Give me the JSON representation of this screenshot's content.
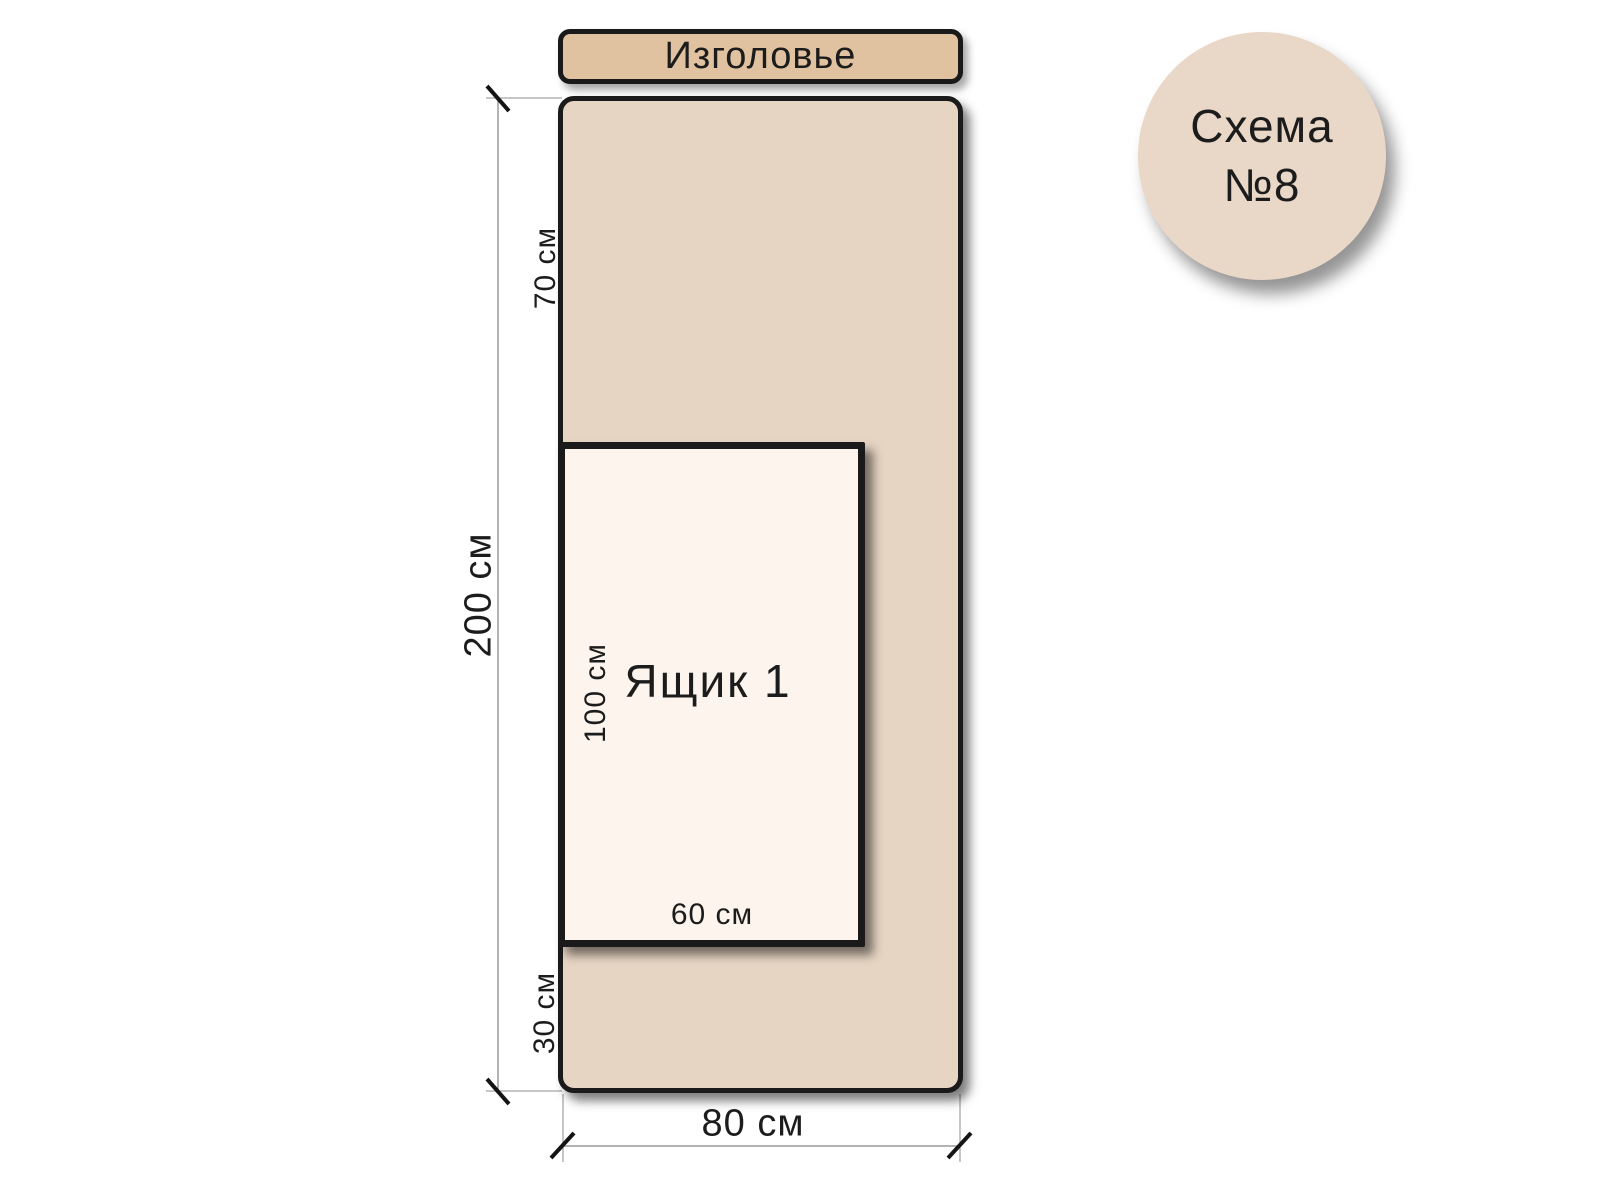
{
  "badge": {
    "line1": "Схема",
    "line2": "№8",
    "fill": "#e9d7c7"
  },
  "headboard": {
    "label": "Изголовье",
    "fill": "#e1c2a0"
  },
  "bed": {
    "length_label": "200 см",
    "width_label": "80 см",
    "headboard_offset_label": "70 см",
    "foot_offset_label": "30 см",
    "fill": "#e7d5c3"
  },
  "drawer": {
    "label": "Ящик 1",
    "length_label": "100 см",
    "width_label": "60 см",
    "fill": "#fdf4ed"
  },
  "colors": {
    "outline": "#1a1a1a",
    "dimension_line": "#9a9a9a",
    "extension_line": "#b3b3b3",
    "tick": "#141414",
    "text": "#1c1c1c",
    "background": "#ffffff"
  }
}
